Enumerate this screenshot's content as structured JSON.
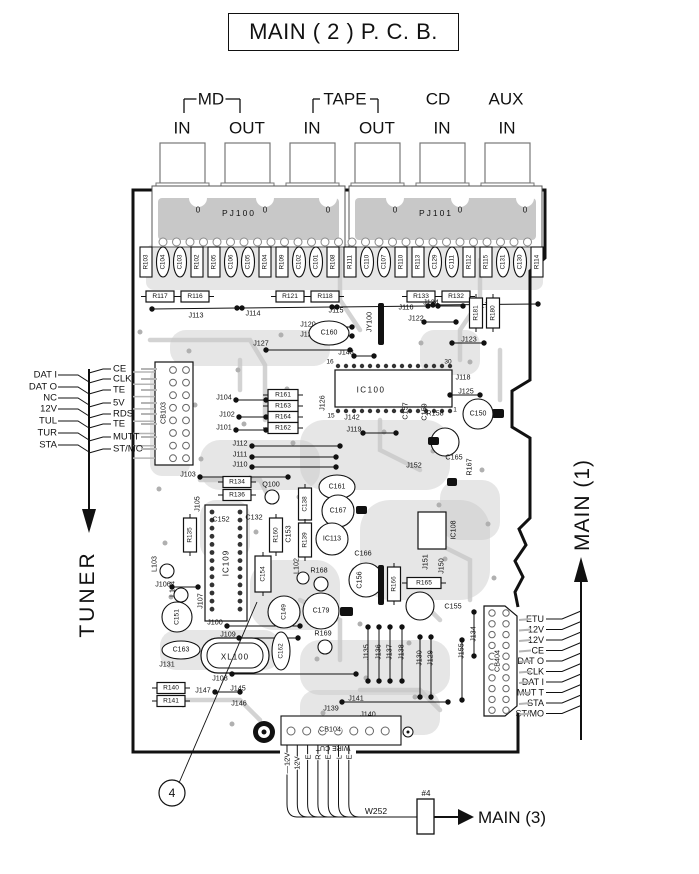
{
  "title": "MAIN ( 2 ) P. C. B.",
  "colors": {
    "ink": "#111111",
    "trace": "#c8c8c8",
    "pad_stroke": "#8a8a8a",
    "leader_gray": "#b5b5b5"
  },
  "pcb": {
    "connector_blocks": [
      "PJ100",
      "PJ101"
    ],
    "zero_mark": "0",
    "jack_groups": [
      {
        "label": "MD",
        "bracket": true,
        "lx": 211,
        "bx1": 184,
        "bx2": 240
      },
      {
        "label": "TAPE",
        "bracket": true,
        "lx": 345,
        "bx1": 313,
        "bx2": 378
      },
      {
        "label": "CD",
        "bracket": false,
        "lx": 438
      },
      {
        "label": "AUX",
        "bracket": false,
        "lx": 506
      }
    ],
    "jack_labels": [
      {
        "t": "IN",
        "x": 182
      },
      {
        "t": "OUT",
        "x": 247
      },
      {
        "t": "IN",
        "x": 312
      },
      {
        "t": "OUT",
        "x": 377
      },
      {
        "t": "IN",
        "x": 442
      },
      {
        "t": "IN",
        "x": 507
      }
    ],
    "top_row": [
      "R103",
      "C104",
      "C103",
      "R102",
      "R105",
      "C106",
      "C105",
      "R104",
      "R109",
      "C102",
      "C101",
      "R108",
      "R111",
      "C110",
      "C107",
      "R110",
      "R113",
      "C129",
      "C111",
      "R112",
      "R115",
      "C131",
      "C130",
      "R114"
    ],
    "r_row": [
      {
        "t": "R117",
        "x": 160
      },
      {
        "t": "R116",
        "x": 195
      },
      {
        "t": "R121",
        "x": 290
      },
      {
        "t": "R118",
        "x": 325
      },
      {
        "t": "R133",
        "x": 421
      },
      {
        "t": "R132",
        "x": 456
      }
    ],
    "components": [
      {
        "t": "J113",
        "x": 196,
        "y": 315
      },
      {
        "t": "J114",
        "x": 253,
        "y": 313
      },
      {
        "t": "J115",
        "x": 336,
        "y": 310
      },
      {
        "t": "J116",
        "x": 406,
        "y": 307
      },
      {
        "t": "J117",
        "x": 481,
        "y": 305
      },
      {
        "t": "J120",
        "x": 308,
        "y": 324
      },
      {
        "t": "J121",
        "x": 308,
        "y": 334
      },
      {
        "t": "J127",
        "x": 261,
        "y": 343
      },
      {
        "t": "C160",
        "x": 329,
        "y": 333,
        "s": "oh",
        "rx": 20,
        "ry": 12
      },
      {
        "t": "JY100",
        "x": 369,
        "y": 322,
        "s": "v"
      },
      {
        "t": "J143",
        "x": 346,
        "y": 352
      },
      {
        "t": "16",
        "x": 330,
        "y": 362,
        "fs": 6.5
      },
      {
        "t": "30",
        "x": 448,
        "y": 362,
        "fs": 6.5
      },
      {
        "t": "15",
        "x": 331,
        "y": 416,
        "fs": 6.5
      },
      {
        "t": "1",
        "x": 455,
        "y": 410,
        "fs": 6.5
      },
      {
        "t": "IC100",
        "x": 371,
        "y": 390,
        "fs": 8,
        "ls": 1.5
      },
      {
        "t": "J126",
        "x": 322,
        "y": 403,
        "s": "v"
      },
      {
        "t": "J142",
        "x": 352,
        "y": 417
      },
      {
        "t": "J119",
        "x": 354,
        "y": 429
      },
      {
        "t": "J124",
        "x": 431,
        "y": 302
      },
      {
        "t": "J122",
        "x": 416,
        "y": 318
      },
      {
        "t": "J123",
        "x": 469,
        "y": 339
      },
      {
        "t": "R181",
        "x": 476,
        "y": 313,
        "s": "vb",
        "h": 30
      },
      {
        "t": "R180",
        "x": 493,
        "y": 313,
        "s": "vb",
        "h": 30
      },
      {
        "t": "J118",
        "x": 463,
        "y": 377
      },
      {
        "t": "J125",
        "x": 466,
        "y": 391
      },
      {
        "t": "R158",
        "x": 435,
        "y": 413
      },
      {
        "t": "C150",
        "x": 478,
        "y": 414,
        "s": "c",
        "r": 15
      },
      {
        "t": "C157",
        "x": 405,
        "y": 411,
        "s": "v"
      },
      {
        "t": "C159",
        "x": 424,
        "y": 412,
        "s": "v"
      },
      {
        "t": "C165",
        "x": 454,
        "y": 457
      },
      {
        "t": "J152",
        "x": 414,
        "y": 465
      },
      {
        "t": "R167",
        "x": 469,
        "y": 467,
        "s": "v"
      },
      {
        "t": "IC108",
        "x": 453,
        "y": 530,
        "s": "v"
      },
      {
        "t": "J151",
        "x": 425,
        "y": 562,
        "s": "v"
      },
      {
        "t": "J150",
        "x": 441,
        "y": 566,
        "s": "v"
      },
      {
        "t": "R165",
        "x": 424,
        "y": 583,
        "s": "hb",
        "w": 34
      },
      {
        "t": "C155",
        "x": 453,
        "y": 606
      },
      {
        "t": "C166",
        "x": 363,
        "y": 553
      },
      {
        "t": "C156",
        "x": 359,
        "y": 580,
        "s": "v"
      },
      {
        "t": "R166",
        "x": 394,
        "y": 584,
        "s": "vb",
        "h": 34
      },
      {
        "t": "R168",
        "x": 319,
        "y": 570
      },
      {
        "t": "C179",
        "x": 321,
        "y": 611,
        "s": "c",
        "r": 18
      },
      {
        "t": "R169",
        "x": 323,
        "y": 633
      },
      {
        "t": "C149",
        "x": 284,
        "y": 612,
        "s": "cv",
        "r": 16
      },
      {
        "t": "C152",
        "x": 221,
        "y": 519
      },
      {
        "t": "C132",
        "x": 254,
        "y": 517
      },
      {
        "t": "IC109",
        "x": 226,
        "y": 563,
        "s": "v",
        "fs": 8,
        "ls": 1
      },
      {
        "t": "C154",
        "x": 263,
        "y": 574,
        "s": "vb",
        "h": 36,
        "w": 16
      },
      {
        "t": "C153",
        "x": 288,
        "y": 534,
        "s": "v"
      },
      {
        "t": "R160",
        "x": 276,
        "y": 535,
        "s": "vb",
        "h": 34
      },
      {
        "t": "C138",
        "x": 305,
        "y": 504,
        "s": "vb",
        "h": 32
      },
      {
        "t": "R139",
        "x": 305,
        "y": 540,
        "s": "vb",
        "h": 34
      },
      {
        "t": "L102",
        "x": 296,
        "y": 566,
        "s": "v"
      },
      {
        "t": "R135",
        "x": 190,
        "y": 535,
        "s": "vb",
        "h": 34
      },
      {
        "t": "J105",
        "x": 197,
        "y": 504,
        "s": "v"
      },
      {
        "t": "L103",
        "x": 154,
        "y": 564,
        "s": "v"
      },
      {
        "t": "L104",
        "x": 172,
        "y": 589,
        "s": "v"
      },
      {
        "t": "J106",
        "x": 163,
        "y": 584
      },
      {
        "t": "C151",
        "x": 177,
        "y": 617,
        "s": "cv",
        "r": 15
      },
      {
        "t": "J107",
        "x": 200,
        "y": 601,
        "s": "v"
      },
      {
        "t": "C163",
        "x": 181,
        "y": 650,
        "s": "oh",
        "rx": 19,
        "ry": 9
      },
      {
        "t": "C162",
        "x": 281,
        "y": 651,
        "s": "ov",
        "rx": 9,
        "ry": 19
      },
      {
        "t": "J131",
        "x": 167,
        "y": 664
      },
      {
        "t": "XL100",
        "x": 235,
        "y": 657,
        "fs": 8,
        "ls": 1
      },
      {
        "t": "J108",
        "x": 220,
        "y": 678
      },
      {
        "t": "J100",
        "x": 215,
        "y": 622
      },
      {
        "t": "J109",
        "x": 228,
        "y": 634
      },
      {
        "t": "R140",
        "x": 171,
        "y": 688,
        "s": "hb"
      },
      {
        "t": "R141",
        "x": 171,
        "y": 701,
        "s": "hb"
      },
      {
        "t": "J147",
        "x": 203,
        "y": 690
      },
      {
        "t": "J145",
        "x": 238,
        "y": 688
      },
      {
        "t": "J146",
        "x": 239,
        "y": 703
      },
      {
        "t": "J135",
        "x": 366,
        "y": 652,
        "s": "v"
      },
      {
        "t": "J136",
        "x": 378,
        "y": 652,
        "s": "v"
      },
      {
        "t": "J137",
        "x": 389,
        "y": 652,
        "s": "v"
      },
      {
        "t": "J138",
        "x": 401,
        "y": 652,
        "s": "v"
      },
      {
        "t": "J130",
        "x": 419,
        "y": 658,
        "s": "v"
      },
      {
        "t": "J129",
        "x": 430,
        "y": 658,
        "s": "v"
      },
      {
        "t": "J155",
        "x": 461,
        "y": 651,
        "s": "v"
      },
      {
        "t": "J134",
        "x": 473,
        "y": 634,
        "s": "v"
      },
      {
        "t": "J141",
        "x": 356,
        "y": 698
      },
      {
        "t": "J139",
        "x": 331,
        "y": 708
      },
      {
        "t": "J140",
        "x": 368,
        "y": 714
      },
      {
        "t": "R134",
        "x": 237,
        "y": 482,
        "s": "hb"
      },
      {
        "t": "R136",
        "x": 237,
        "y": 495,
        "s": "hb"
      },
      {
        "t": "Q100",
        "x": 271,
        "y": 484
      },
      {
        "t": "R161",
        "x": 283,
        "y": 395,
        "s": "hb",
        "w": 30
      },
      {
        "t": "R163",
        "x": 283,
        "y": 406,
        "s": "hb",
        "w": 30
      },
      {
        "t": "R164",
        "x": 283,
        "y": 417,
        "s": "hb",
        "w": 30
      },
      {
        "t": "R162",
        "x": 283,
        "y": 428,
        "s": "hb",
        "w": 30
      },
      {
        "t": "J104",
        "x": 224,
        "y": 397
      },
      {
        "t": "J102",
        "x": 227,
        "y": 414
      },
      {
        "t": "J101",
        "x": 224,
        "y": 427
      },
      {
        "t": "J112",
        "x": 240,
        "y": 443
      },
      {
        "t": "J111",
        "x": 240,
        "y": 454
      },
      {
        "t": "J110",
        "x": 240,
        "y": 464
      },
      {
        "t": "J103",
        "x": 188,
        "y": 474
      },
      {
        "t": "C161",
        "x": 337,
        "y": 487,
        "s": "oh",
        "rx": 18,
        "ry": 12
      },
      {
        "t": "C167",
        "x": 338,
        "y": 511,
        "s": "c",
        "r": 16
      },
      {
        "t": "IC113",
        "x": 332,
        "y": 539,
        "s": "c",
        "r": 16
      },
      {
        "t": "CB103",
        "x": 163,
        "y": 413,
        "s": "v"
      },
      {
        "t": "CB104",
        "x": 330,
        "y": 729,
        "halo": true
      },
      {
        "t": "CB404",
        "x": 497,
        "y": 661,
        "s": "v",
        "halo": true
      }
    ]
  },
  "left_port": {
    "name": "TUNER",
    "col1": [
      "DAT I",
      "DAT O",
      "NC",
      "12V",
      "TUL",
      "TUR",
      "STA"
    ],
    "col2": [
      "CE",
      "CLK",
      "TE",
      "5V",
      "RDS",
      "TE",
      "MUTT",
      "ST/MO"
    ]
  },
  "right_port": {
    "name": "MAIN (1)",
    "signals": [
      "ETU",
      "—12V",
      "12V",
      "CE",
      "DAT O",
      "CLK",
      "DAT I",
      "MUT T",
      "STA",
      "ST/MO"
    ]
  },
  "bottom_port": {
    "name": "MAIN (3)",
    "wire_id": "W252",
    "tag": "#4",
    "callout": "4",
    "note": "WIRE CUT",
    "wire_labels": [
      "—12V",
      "12V",
      "E",
      "R",
      "E",
      "L",
      "E"
    ]
  }
}
